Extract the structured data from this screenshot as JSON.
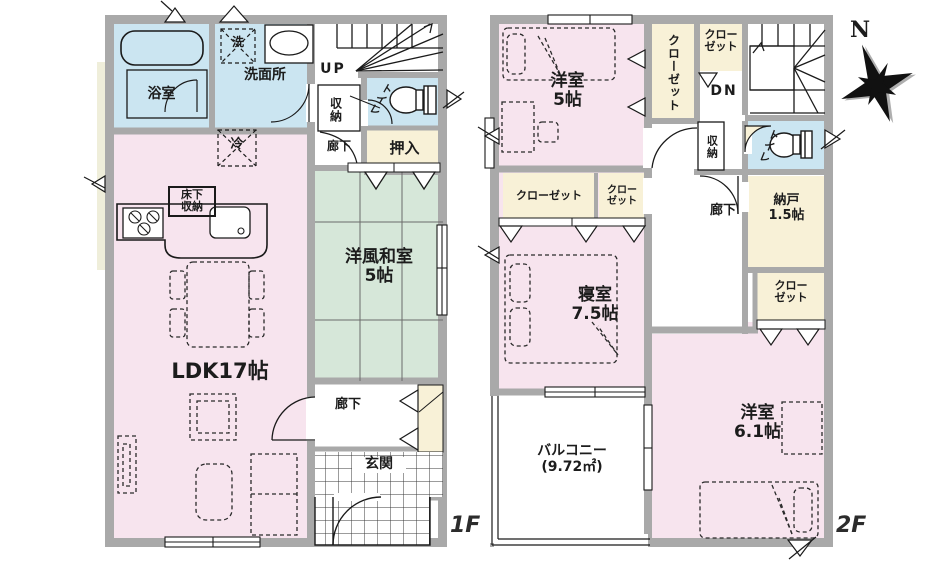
{
  "colors": {
    "wall": "#a9a9a9",
    "room_pink": "#f7e4ee",
    "room_blue": "#cbe5f1",
    "room_tatami_green": "#d6e7d9",
    "room_cream": "#f8f1d7",
    "line": "#1a1a1a"
  },
  "compass": {
    "north": "N"
  },
  "floor1": {
    "label": "1F",
    "bathroom": "浴室",
    "washer": "洗",
    "washroom": "洗面所",
    "stairs": "UP",
    "closet": "収納",
    "toilet": "トイレ",
    "hall_upper": "廊下",
    "oshiire": "押入",
    "fridge": "冷",
    "underfloor": "床下\n収納",
    "tatami": "洋風和室\n5帖",
    "ldk": "LDK17帖",
    "hall_lower": "廊下",
    "entrance": "玄関"
  },
  "floor2": {
    "label": "2F",
    "bedroom_5": "洋室\n5帖",
    "closet_tall": "クローゼット",
    "closet_top": "クロー\nゼット",
    "stairs": "DN",
    "closet_small": "収納",
    "toilet": "トイレ",
    "hall": "廊下",
    "storeroom": "納戸\n1.5帖",
    "closet_right": "クロー\nゼット",
    "closet_a": "クローゼット",
    "closet_b": "クロー\nゼット",
    "bedroom_main": "寝室\n7.5帖",
    "balcony": "バルコニー\n(9.72㎡)",
    "bedroom_61": "洋室\n6.1帖"
  }
}
